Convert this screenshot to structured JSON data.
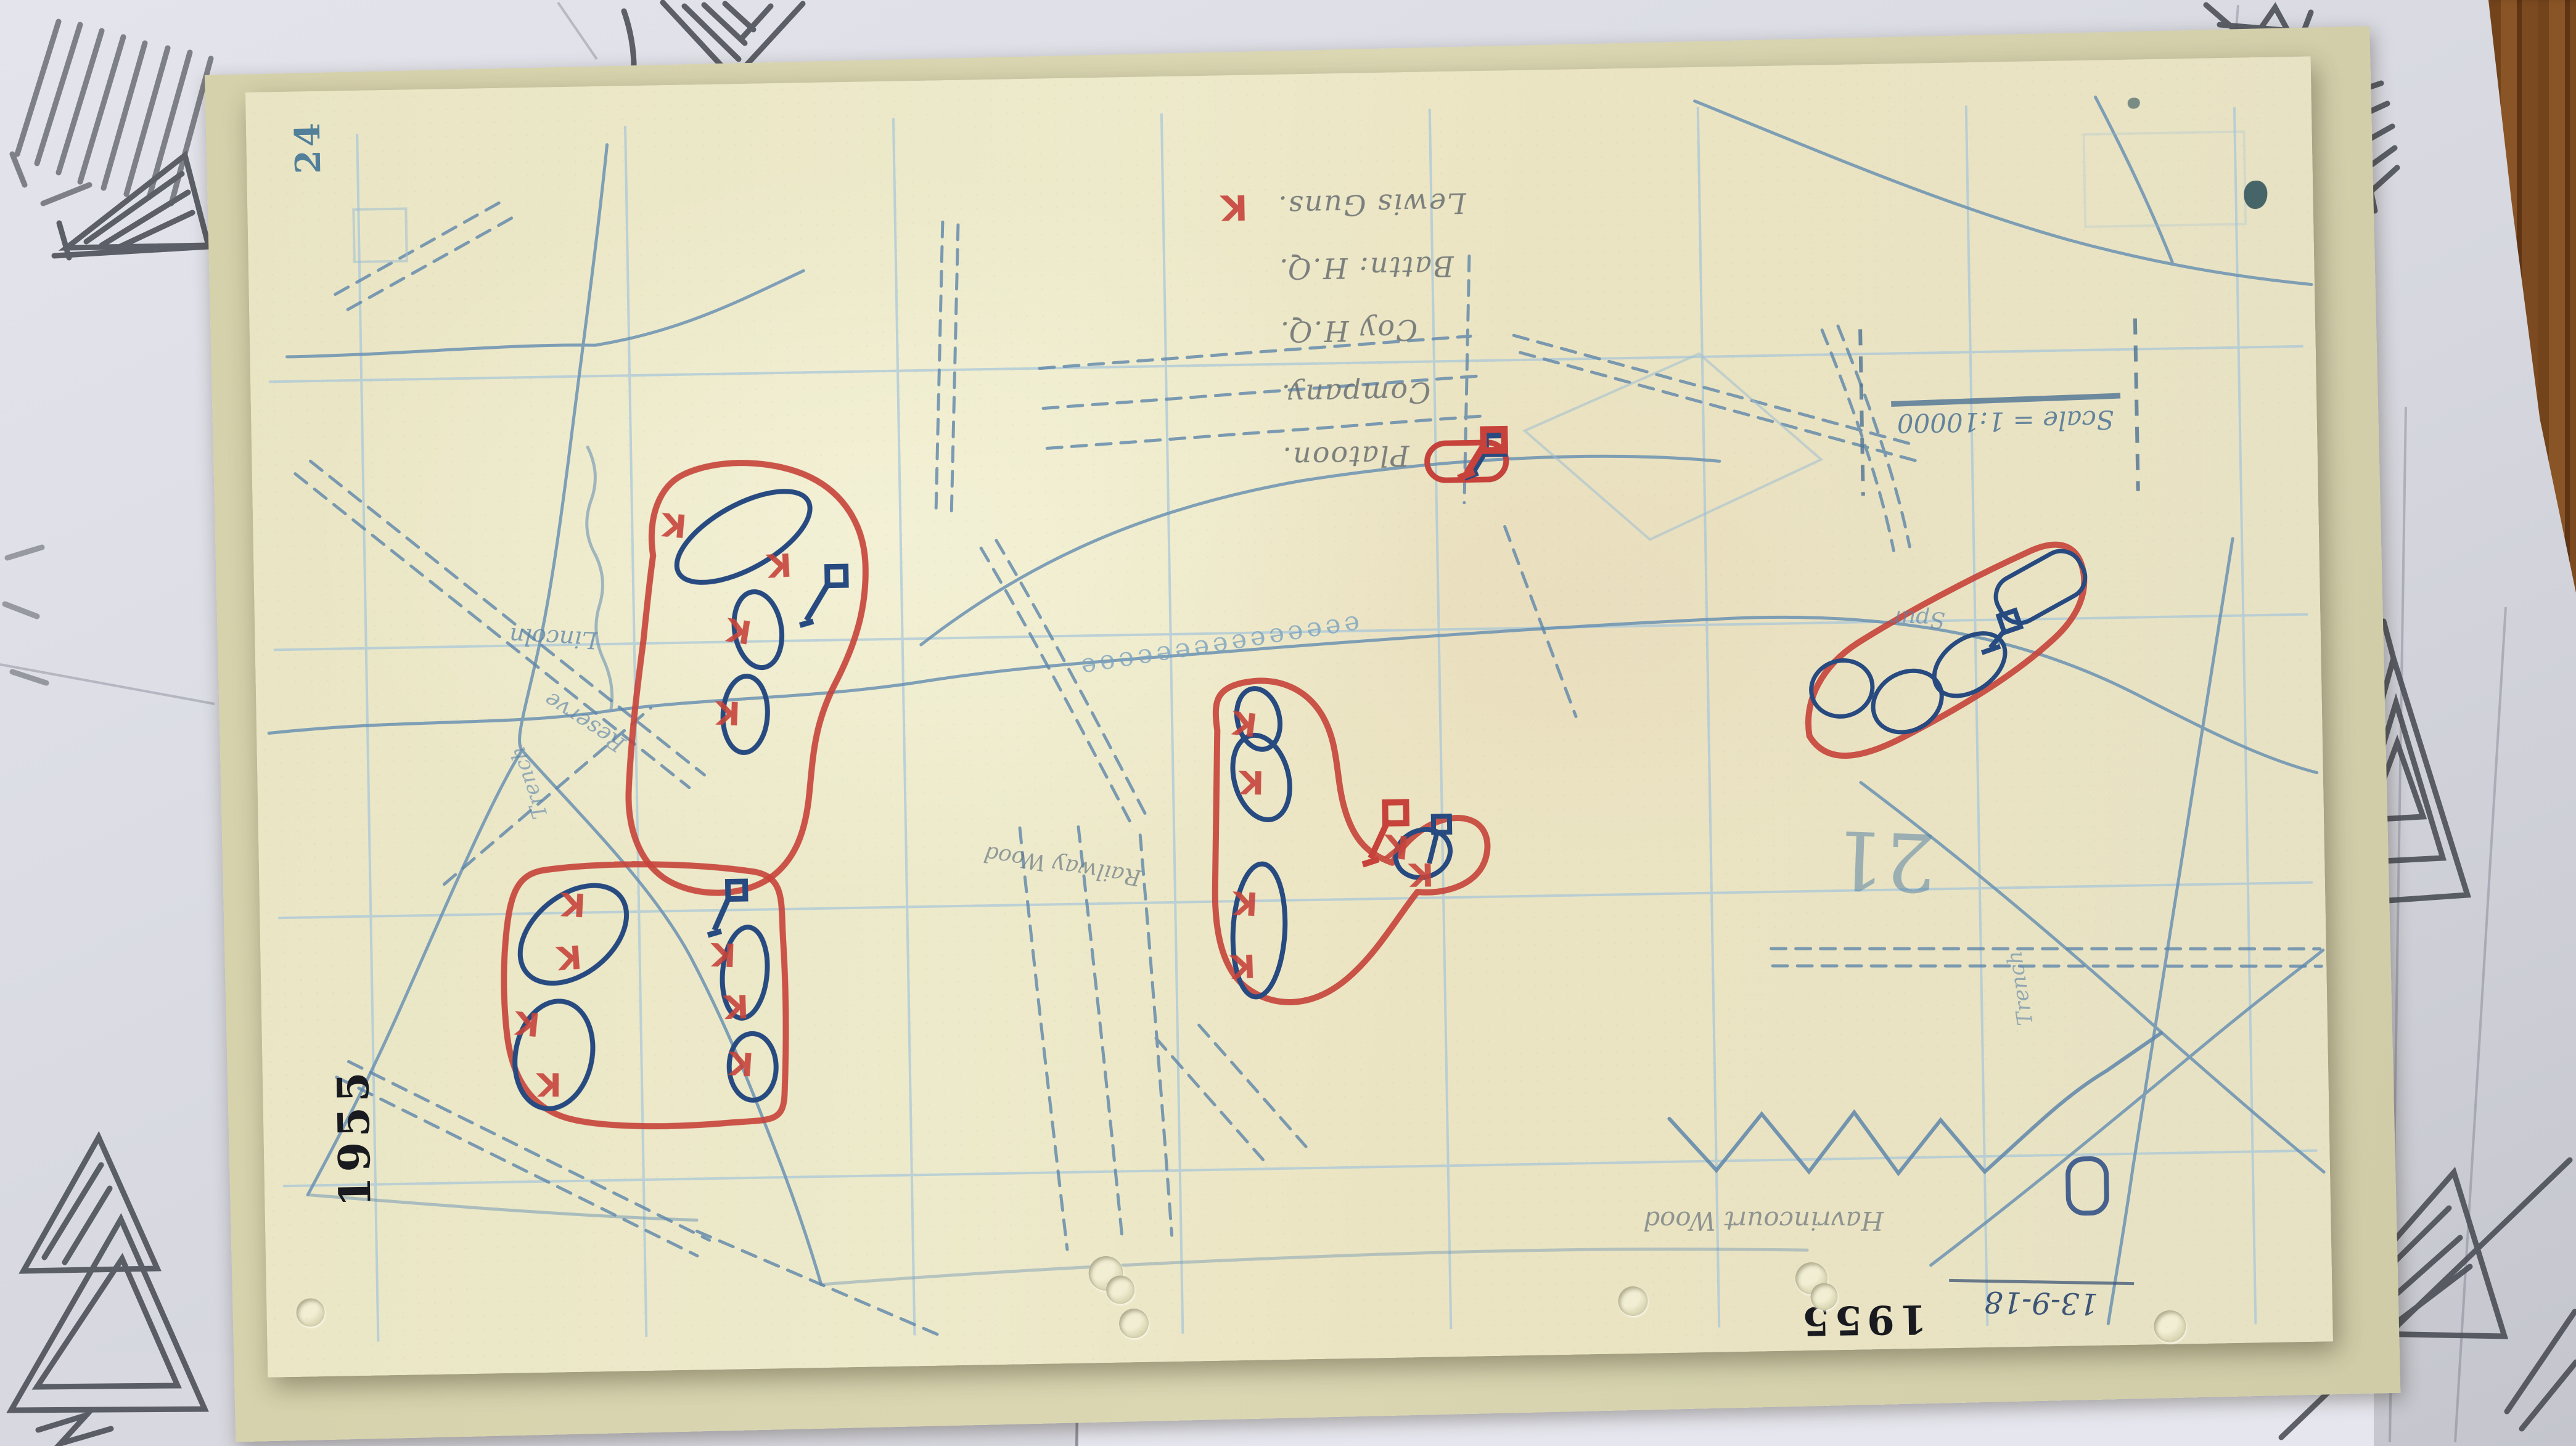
{
  "sheet": {
    "page_number": "24",
    "grid_square_number": "21",
    "scale_text": "Scale = 1:10000",
    "date": "13-9-18",
    "stamp_left": "1955",
    "stamp_right": "1955"
  },
  "legend": {
    "rows": [
      {
        "label": "Platoon.",
        "symbol": "platoon-oval-blue"
      },
      {
        "label": "Company.",
        "symbol": "company-oval-red"
      },
      {
        "label": "Coy H.Q.",
        "symbol": "flag-blue"
      },
      {
        "label": "Battn: H.Q.",
        "symbol": "flag-red"
      },
      {
        "label": "Lewis Guns.",
        "symbol": "letter-k-red"
      }
    ],
    "lewis_gun_letter": "K"
  },
  "map": {
    "labels": [
      {
        "text": "Lincoln"
      },
      {
        "text": "Reserve"
      },
      {
        "text": "Trench"
      },
      {
        "text": "Railway Wood"
      },
      {
        "text": "Havrincourt Wood"
      },
      {
        "text": "Spur"
      },
      {
        "text": "Trench"
      }
    ],
    "hedgerow_glyphs": "eeeeeeeeeeeeeee"
  },
  "colors": {
    "company_red": "#c6423a",
    "platoon_blue": "#274a80",
    "map_print_blue": "#6b92b2",
    "paper_cream": "#ebe7c6",
    "backing_white": "#dddee6",
    "pencil_gray": "#3b3f46",
    "wood_brown": "#7c4a20"
  }
}
